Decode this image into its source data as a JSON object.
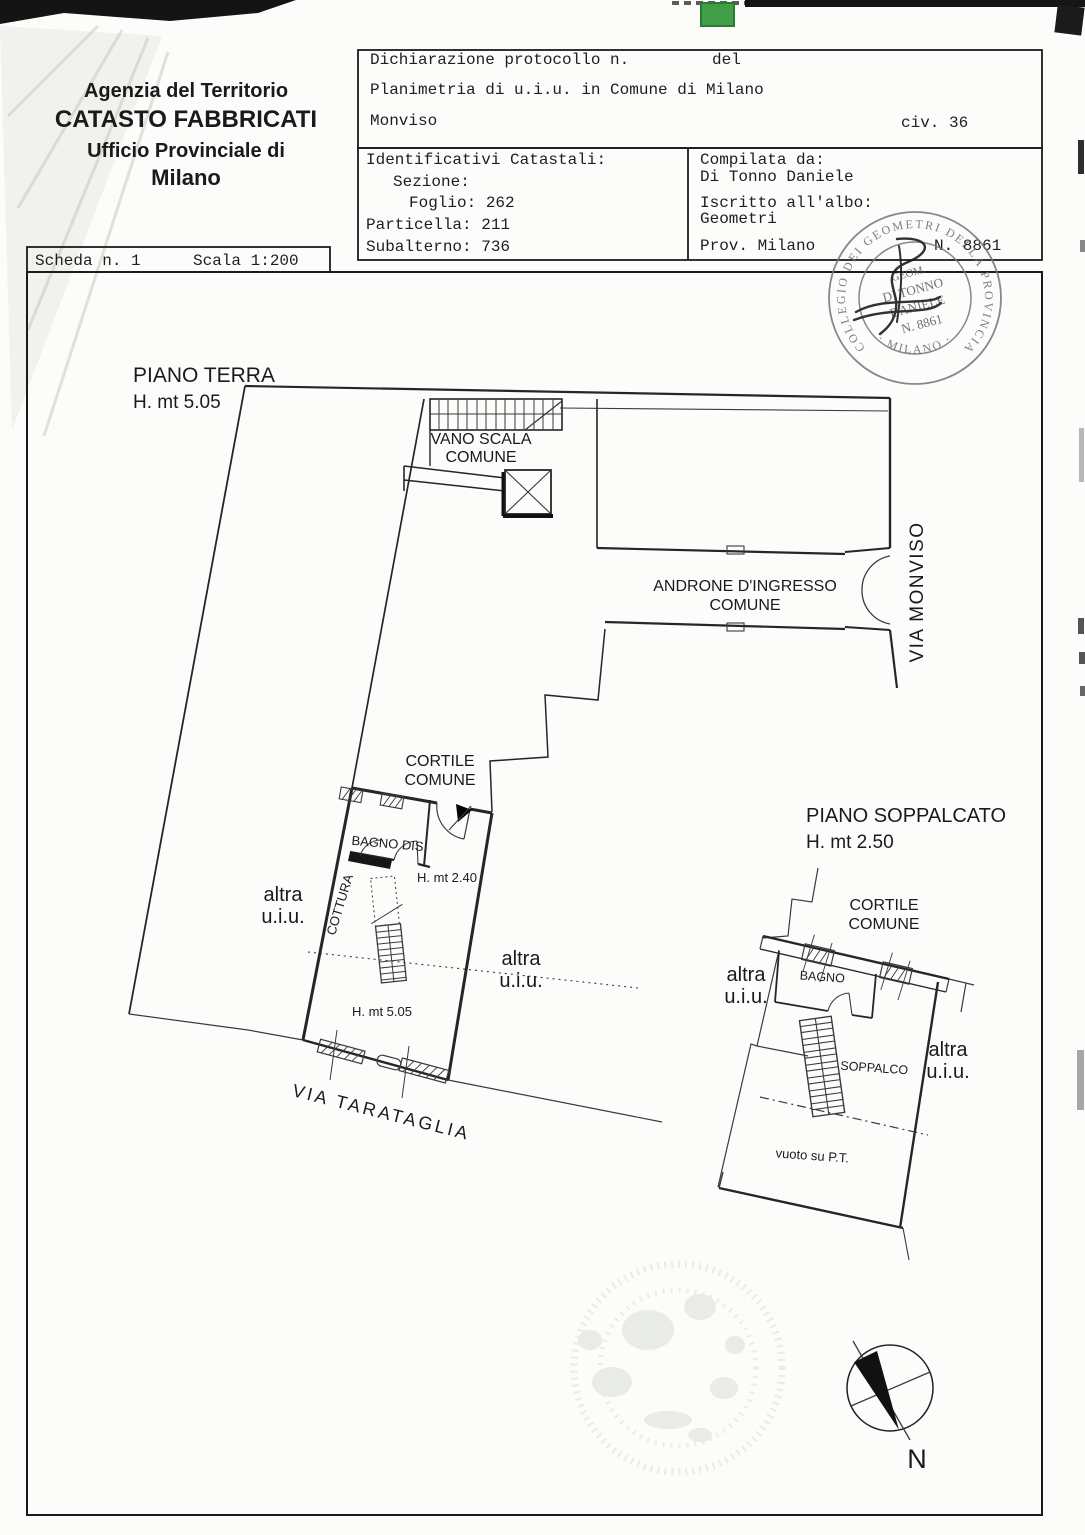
{
  "artifacts": {
    "green_fill": "#3f9e46",
    "green_stroke": "#2a7a33",
    "scan_bar_color": "#151515"
  },
  "agency_header": {
    "line1": "Agenzia del Territorio",
    "line2": "CATASTO FABBRICATI",
    "line3": "Ufficio Provinciale di",
    "line4": "Milano"
  },
  "declaration": {
    "protocol_label": "Dichiarazione protocollo n.",
    "protocol_del": "del",
    "planimetria": "Planimetria di u.i.u. in Comune di Milano",
    "street": "Monviso",
    "civic": "civ. 36"
  },
  "cadastral": {
    "title": "Identificativi Catastali:",
    "sezione": "Sezione:",
    "foglio": "Foglio: 262",
    "particella": "Particella: 211",
    "subalterno": "Subalterno: 736"
  },
  "compiler": {
    "compiled_by_label": "Compilata da:",
    "name": "Di Tonno Daniele",
    "albo_label": "Iscritto all'albo:",
    "albo": "Geometri",
    "prov": "Prov. Milano",
    "number": "N. 8861"
  },
  "sheet": {
    "scheda": "Scheda n. 1",
    "scala": "Scala 1:200"
  },
  "stamp": {
    "ring_top": "COLLEGIO DEI GEOMETRI DELLA PROVINCIA",
    "ring_bottom": "· MILANO ·",
    "inner": [
      "GEOM.",
      "DI TONNO",
      "DANIELE",
      "N. 8861"
    ]
  },
  "ground_floor": {
    "title": "PIANO TERRA",
    "height": "H. mt 5.05",
    "vano_scala": [
      "VANO SCALA",
      "COMUNE"
    ],
    "androne": [
      "ANDRONE D'INGRESSO",
      "COMUNE"
    ],
    "via_monviso": "VIA MONVISO",
    "cortile": [
      "CORTILE",
      "COMUNE"
    ],
    "bagno_dis": "BAGNO DIS.",
    "cottura": "COTTURA",
    "h_240": "H. mt 2.40",
    "h_505": "H. mt 5.05",
    "altra_left": [
      "altra",
      "u.i.u."
    ],
    "altra_right": [
      "altra",
      "u.i.u."
    ],
    "via_tarataglia": "VIA TARATAGLIA"
  },
  "mezzanine": {
    "title": "PIANO SOPPALCATO",
    "height": "H. mt 2.50",
    "cortile": [
      "CORTILE",
      "COMUNE"
    ],
    "bagno": "BAGNO",
    "soppalco": "SOPPALCO",
    "vuoto": "vuoto su P.T.",
    "altra_left": [
      "altra",
      "u.i.u."
    ],
    "altra_right": [
      "altra",
      "u.i.u."
    ]
  },
  "compass": {
    "north": "N"
  }
}
